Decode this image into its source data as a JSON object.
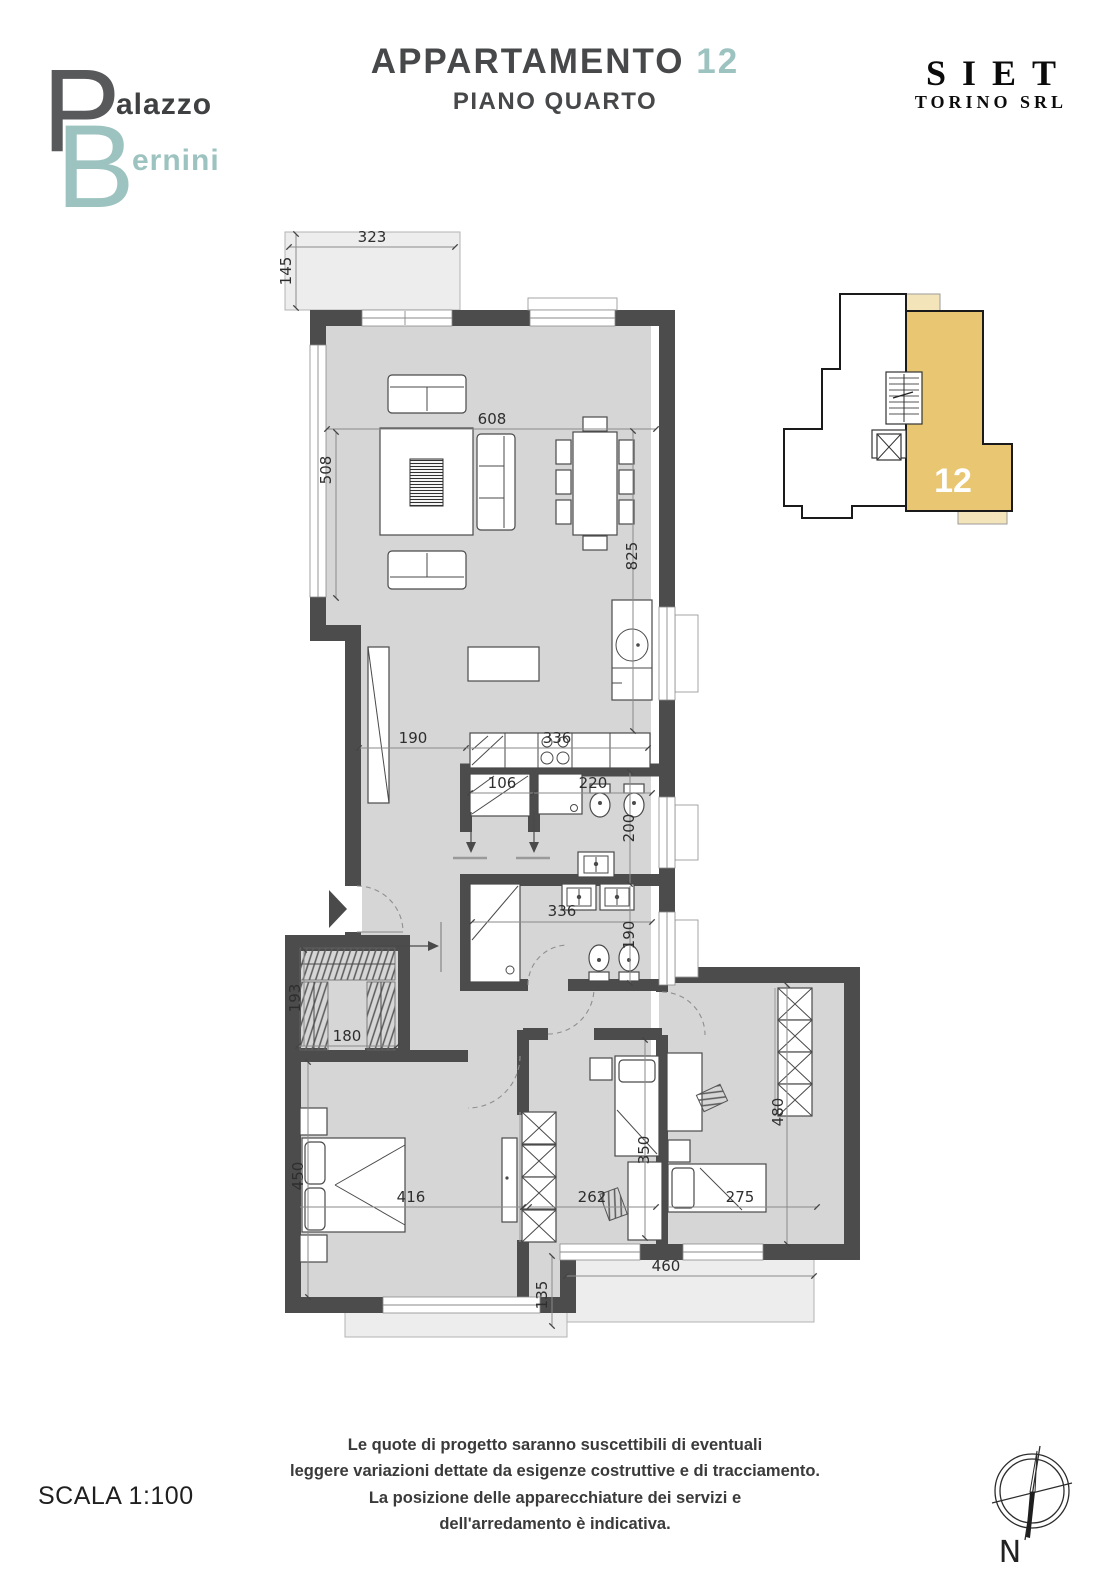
{
  "header": {
    "logo": {
      "initial_top": "P",
      "rest_top": "alazzo",
      "initial_bottom": "B",
      "rest_bottom": "ernini"
    },
    "title": "APPARTAMENTO",
    "unit_number": "12",
    "subtitle": "PIANO QUARTO",
    "company_name": "SIET",
    "company_sub": "TORINO SRL"
  },
  "key_plan": {
    "unit_label": "12"
  },
  "plan": {
    "dims": {
      "balcony_top_w": "323",
      "balcony_top_d": "145",
      "living_w": "608",
      "living_h_left": "508",
      "living_h_right": "825",
      "kitchen_left": "190",
      "kitchen_w": "336",
      "bath1_closet_w": "106",
      "bath1_w": "220",
      "bath1_h": "200",
      "bath2_w": "336",
      "bath2_h": "190",
      "closet_w": "180",
      "closet_h": "193",
      "bedroom1_h": "450",
      "bedroom1_w": "416",
      "bedroom2_w": "262",
      "bedroom2_h": "350",
      "bedroom3_w": "275",
      "bedroom3_h": "480",
      "balcony_bottom_w": "460",
      "balcony_bottom_d": "135"
    }
  },
  "footer": {
    "disclaimer": [
      "Le quote di progetto saranno suscettibili di eventuali",
      "leggere variazioni dettate da esigenze costruttive e di tracciamento.",
      "La posizione delle apparecchiature dei servizi e",
      "dell'arredamento è indicativa."
    ],
    "scale": "SCALA 1:100",
    "compass_label": "N"
  },
  "colors": {
    "accent_teal": "#9cc3c0",
    "wall": "#4c4c4c",
    "unit_fill": "#e8c672",
    "unit_balcony_fill": "#f4e4ba"
  }
}
